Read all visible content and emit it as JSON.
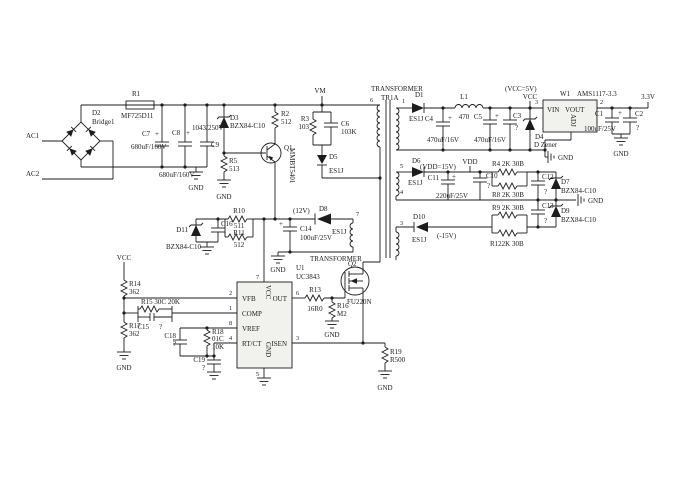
{
  "figure": {
    "type": "circuit-schematic",
    "background": "#ffffff",
    "ink": "#1c1c1c"
  },
  "t": {
    "ac1": "AC1",
    "ac2": "AC2",
    "vm": "VM",
    "vcc": "VCC",
    "gnd": "GND",
    "vdd": "VDD",
    "v33": "3.3V",
    "vcc5_note": "(VCC=5V)",
    "vdd_note": "(VDD=15V)",
    "v12_note": "(12V)",
    "v15n_note": "(-15V)",
    "plus": "+",
    "q": "?",
    "r1": "R1",
    "r1v": "MF725D11",
    "d2": "D2",
    "d2v": "Bridge1",
    "c7": "C7",
    "c8": "C8",
    "c9": "C9",
    "v680uf": "680uF/160V",
    "c9v": "1043/250V",
    "d3": "D3",
    "bzx": "BZX84-C10",
    "r5": "R5",
    "r5v": "513",
    "r2": "R2",
    "r2v": "512",
    "q1": "Q1",
    "q1v": "MMBT5401",
    "r3": "R3",
    "r3v": "103",
    "c6": "C6",
    "c6v": "103K",
    "d5": "D5",
    "es1j": "ES1J",
    "r10": "R10",
    "r10v": "511",
    "r11": "R11",
    "r11v": "512",
    "d11": "D11",
    "c16": "C16",
    "c14": "C14",
    "v100uf": "100uF/25V",
    "d8": "D8",
    "transformer": "TRANSFORMER",
    "tr1a": "TR1A",
    "n1": "1",
    "n2": "2",
    "n3": "3",
    "n4": "4",
    "n5": "5",
    "n6": "6",
    "n7": "7",
    "n8": "8",
    "q2": "Q2",
    "q2v": "FU220N",
    "r13": "R13",
    "r13v": "16R0",
    "r16": "R16",
    "r16v": "M2",
    "r19": "R19",
    "r19v": "R500",
    "u1": "U1",
    "u1v": "UC3843",
    "vfb": "VFB",
    "comp": "COMP",
    "vref": "VREF",
    "rtct": "RT/CT",
    "out": "OUT",
    "isen": "ISEN",
    "r14": "R14",
    "v362": "362",
    "r15_label": "R15 30C 20K",
    "c15": "C15",
    "r17": "R17",
    "c18": "C18",
    "r18": "R18",
    "r18c": "01C",
    "r18v": "10K",
    "c19": "C19",
    "d1": "D1",
    "l1": "L1",
    "l1v": "470",
    "c4": "C4",
    "v470uf": "470uF/16V",
    "c5": "C5",
    "c3": "C3",
    "d4": "D4",
    "d4v": "D Zener",
    "w1": "W1",
    "w1v": "AMS1117-3.3",
    "vin": "VIN",
    "vout": "VOUT",
    "adj": "ADJ",
    "c1": "C1",
    "c2": "C2",
    "d6": "D6",
    "c11": "C11",
    "c11v": "220uF/25V",
    "c10": "C10",
    "r4_label": "R4 2K 30B",
    "r8_label": "R8 2K 30B",
    "r9_label": "R9 2K 30B",
    "r12_label": "R122K 30B",
    "c12": "C12",
    "d7": "D7",
    "c13": "C13",
    "d9": "D9",
    "d10": "D10"
  }
}
